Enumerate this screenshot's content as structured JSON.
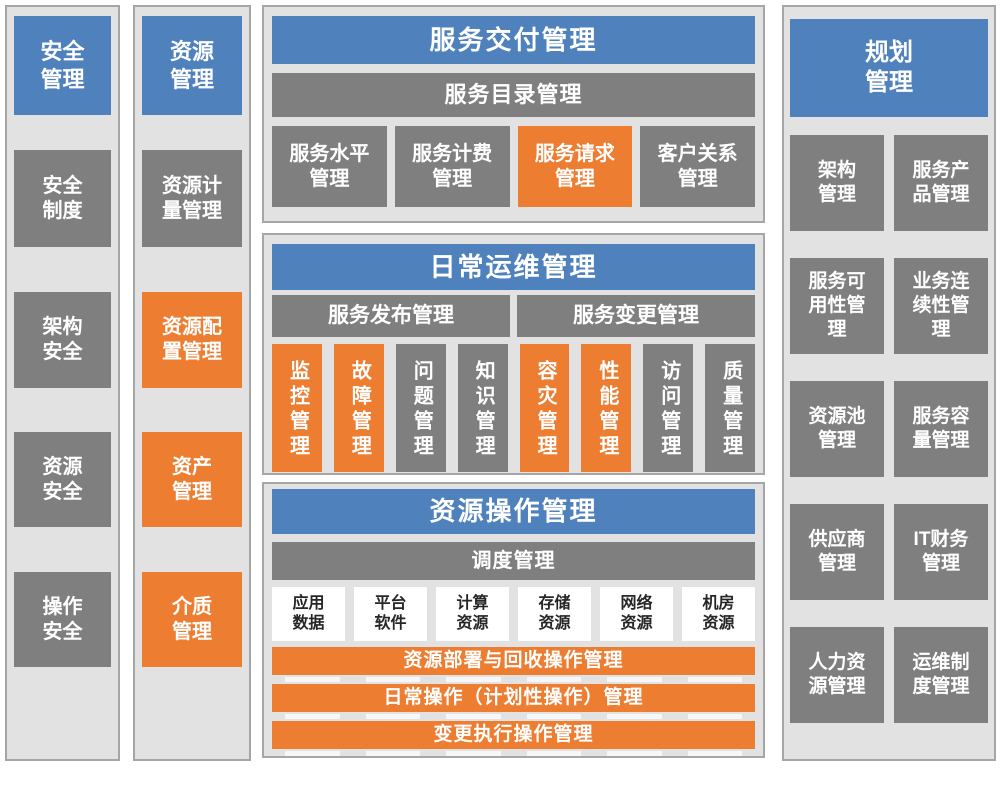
{
  "colors": {
    "header_blue": "#4F81BD",
    "block_gray": "#7F7F7F",
    "block_orange": "#ED7D31",
    "panel_background": "#E2E2E2",
    "panel_border": "#A6A6A6",
    "white_block_text": "#262626"
  },
  "security": {
    "title": "安全管理",
    "items": [
      {
        "label": "安全制度",
        "color": "gray"
      },
      {
        "label": "架构安全",
        "color": "gray"
      },
      {
        "label": "资源安全",
        "color": "gray"
      },
      {
        "label": "操作安全",
        "color": "gray"
      }
    ]
  },
  "resource": {
    "title": "资源管理",
    "items": [
      {
        "label": "资源计量管理",
        "color": "gray"
      },
      {
        "label": "资源配置管理",
        "color": "orange"
      },
      {
        "label": "资产管理",
        "color": "orange"
      },
      {
        "label": "介质管理",
        "color": "orange"
      }
    ]
  },
  "service_delivery": {
    "title": "服务交付管理",
    "catalog_bar": "服务目录管理",
    "items": [
      {
        "label": "服务水平管理",
        "color": "gray"
      },
      {
        "label": "服务计费管理",
        "color": "gray"
      },
      {
        "label": "服务请求管理",
        "color": "orange"
      },
      {
        "label": "客户关系管理",
        "color": "gray"
      }
    ]
  },
  "daily_ops": {
    "title": "日常运维管理",
    "bars": [
      {
        "label": "服务发布管理"
      },
      {
        "label": "服务变更管理"
      }
    ],
    "items": [
      {
        "label": "监控管理",
        "color": "orange"
      },
      {
        "label": "故障管理",
        "color": "orange"
      },
      {
        "label": "问题管理",
        "color": "gray"
      },
      {
        "label": "知识管理",
        "color": "gray"
      },
      {
        "label": "容灾管理",
        "color": "orange"
      },
      {
        "label": "性能管理",
        "color": "orange"
      },
      {
        "label": "访问管理",
        "color": "gray"
      },
      {
        "label": "质量管理",
        "color": "gray"
      }
    ]
  },
  "resource_ops": {
    "title": "资源操作管理",
    "schedule_bar": "调度管理",
    "resources": [
      {
        "label": "应用数据"
      },
      {
        "label": "平台软件"
      },
      {
        "label": "计算资源"
      },
      {
        "label": "存储资源"
      },
      {
        "label": "网络资源"
      },
      {
        "label": "机房资源"
      }
    ],
    "operation_bars": [
      {
        "label": "资源部署与回收操作管理"
      },
      {
        "label": "日常操作（计划性操作）管理"
      },
      {
        "label": "变更执行操作管理"
      }
    ]
  },
  "planning": {
    "title": "规划管理",
    "items": [
      {
        "label": "架构管理",
        "color": "gray"
      },
      {
        "label": "服务产品管理",
        "color": "gray"
      },
      {
        "label": "服务可用性管理",
        "color": "gray"
      },
      {
        "label": "业务连续性管理",
        "color": "gray"
      },
      {
        "label": "资源池管理",
        "color": "gray"
      },
      {
        "label": "服务容量管理",
        "color": "gray"
      },
      {
        "label": "供应商管理",
        "color": "gray"
      },
      {
        "label": "IT财务管理",
        "color": "gray"
      },
      {
        "label": "人力资源管理",
        "color": "gray"
      },
      {
        "label": "运维制度管理",
        "color": "gray"
      }
    ]
  }
}
